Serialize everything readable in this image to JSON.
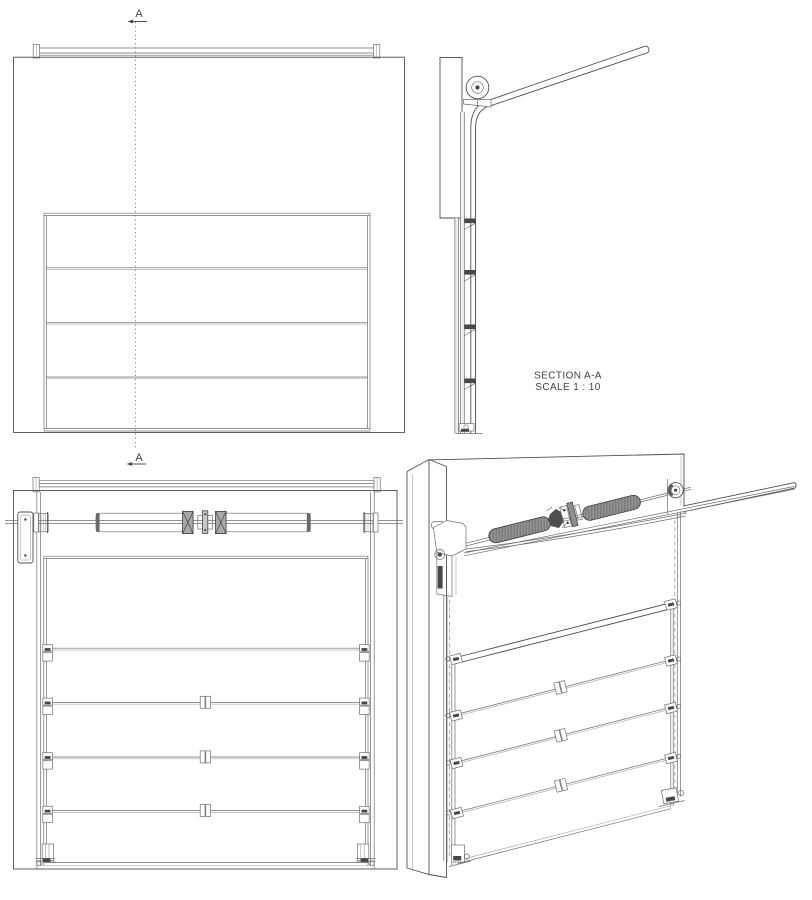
{
  "document": {
    "kind": "engineering drawing",
    "subject": "sectional overhead garage door with torsion spring assembly",
    "background_color": "#ffffff",
    "line_color": "#4f4f4f",
    "text_color": "#3f3f3f",
    "spring_fill_front": "#e8e8e8",
    "spring_fill_iso": "#7b7b7b"
  },
  "section_markers": {
    "top_label": "A",
    "bottom_label": "A"
  },
  "section_view": {
    "title": "SECTION A-A",
    "scale_note": "SCALE 1 : 10"
  },
  "views": {
    "exterior_front": {
      "name": "exterior front elevation",
      "door_panel_count": 4,
      "seam_count": 3
    },
    "section_aa": {
      "name": "side section through wall and track",
      "roller_bracket_count": 4
    },
    "interior_front": {
      "name": "interior elevation with torsion springs",
      "spring_count": 2,
      "cable_drum_count": 2,
      "hinge_row_count": 4
    },
    "isometric": {
      "name": "interior isometric view",
      "spring_count": 2
    }
  },
  "components": [
    "brick wall",
    "horizontal track",
    "vertical track",
    "track curve",
    "torsion shaft",
    "torsion spring",
    "winding cone",
    "center bearing coupler",
    "cable drum",
    "end bearing bracket",
    "door panel",
    "panel seam",
    "side hinge",
    "center hinge",
    "bottom bracket",
    "roller"
  ]
}
